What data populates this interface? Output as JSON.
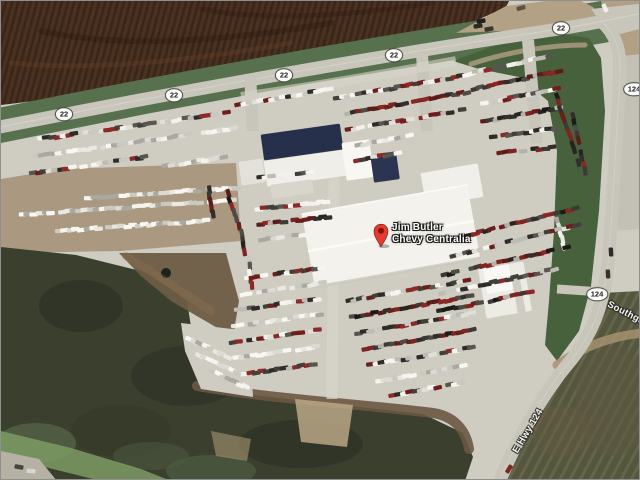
{
  "overlays": {
    "pin": {
      "line1": "Jim Butler",
      "line2": "Chevy Centralia",
      "color": "#e8392c",
      "dot_color": "#7c150e"
    },
    "shields": [
      {
        "text": "22",
        "x": 63,
        "y": 113
      },
      {
        "text": "22",
        "x": 173,
        "y": 94
      },
      {
        "text": "22",
        "x": 283,
        "y": 74
      },
      {
        "text": "22",
        "x": 393,
        "y": 54
      },
      {
        "text": "22",
        "x": 560,
        "y": 27
      },
      {
        "text": "124",
        "x": 633,
        "y": 88
      },
      {
        "text": "124",
        "x": 596,
        "y": 293
      }
    ],
    "road_labels": [
      {
        "text": "E Hwy 124",
        "angle": -59
      },
      {
        "text": "Southgate",
        "angle": 27
      }
    ]
  },
  "satellite": {
    "palettes": {
      "light": [
        "#f4f3ee",
        "#e9e8e2",
        "#dbdad3",
        "#cac9c1",
        "#f8f7f2",
        "#a9a8a1"
      ],
      "mix": [
        "#f2f1eb",
        "#e0dfd8",
        "#bcbbb4",
        "#57564f",
        "#2d2c29",
        "#8b2a26",
        "#c9c8c1",
        "#403f3a",
        "#f6f5f0",
        "#6e1f1d"
      ],
      "dark": [
        "#302f2b",
        "#4c4b46",
        "#1b1a17",
        "#7e2522",
        "#5c1c1a",
        "#b3b2ab",
        "#3b3a36",
        "#8d2623",
        "#262522",
        "#6a1e1b"
      ]
    },
    "layers": [
      {
        "t": "poly",
        "n": "base-pavement",
        "p": "0,0 640,0 640,480 0,480",
        "f": "#cfccc2"
      },
      {
        "t": "poly",
        "n": "plowed-field",
        "p": "0,0 508,0 505,6 470,22 300,62 150,86 0,104",
        "f": "#452e1f"
      },
      {
        "t": "poly",
        "n": "plowed-field-texture",
        "p": "0,0 508,0 505,6 470,22 300,62 150,86 0,104",
        "f": "url(#furrows)"
      },
      {
        "t": "path",
        "n": "field-streak-1",
        "d": "M40,30 C120,48 230,40 330,22",
        "s": "rgba(30,16,8,.25)",
        "w": 6
      },
      {
        "t": "path",
        "n": "field-streak-2",
        "d": "M10,62 C90,70 190,60 290,42",
        "s": "rgba(140,95,55,.16)",
        "w": 5
      },
      {
        "t": "path",
        "n": "field-streak-3",
        "d": "M200,8 C260,20 340,16 430,2",
        "s": "rgba(30,16,8,.2)",
        "w": 5
      },
      {
        "t": "path",
        "n": "grass-hwy22",
        "d": "M-6,129 C150,97 350,60 558,28 C590,23 615,19 646,12",
        "s": "#57704d",
        "w": 42,
        "cap": "butt"
      },
      {
        "t": "poly",
        "n": "lot-main",
        "p": "0,142 150,112 300,84 460,58 520,73 548,98 558,150 554,260 545,330 536,352 480,410 360,402 250,394 196,386 184,330 150,270 78,252 0,246",
        "f": "#cfccc2"
      },
      {
        "t": "poly",
        "n": "grass-median-ne",
        "p": "452,60 500,42 555,32 588,37 600,57 604,110 598,210 590,285 578,330 556,360 544,344 548,300 553,230 556,150 547,100 518,76 478,68",
        "f": "#47613d"
      },
      {
        "t": "path",
        "n": "median-dirt-edge",
        "d": "M470,63 C510,50 550,44 584,44",
        "s": "#b1a084",
        "w": 5,
        "o": 0.8
      },
      {
        "t": "poly",
        "n": "dirt-lot-west",
        "p": "0,178 60,168 235,162 240,240 120,250 0,252",
        "f": "#ab9880"
      },
      {
        "t": "poly",
        "n": "scrubland-sw",
        "p": "0,246 75,254 148,272 186,300 193,345 207,386 252,394 332,403 422,413 462,432 472,456 464,480 0,480",
        "f": "#3b3f2e"
      },
      {
        "t": "ellipse",
        "n": "scrub-dark-blobs",
        "items": [
          [
            80,
            305,
            42,
            26,
            "#2a2e22",
            0.55
          ],
          [
            185,
            375,
            55,
            30,
            "#2a2e22",
            0.5
          ],
          [
            300,
            443,
            62,
            24,
            "#272b20",
            0.5
          ],
          [
            120,
            430,
            50,
            26,
            "#333726",
            0.5
          ]
        ]
      },
      {
        "t": "ellipse",
        "n": "scrub-green-blobs",
        "items": [
          [
            35,
            442,
            40,
            20,
            "#5c6d4e",
            0.6
          ],
          [
            210,
            470,
            45,
            16,
            "#566749",
            0.5
          ],
          [
            150,
            455,
            38,
            14,
            "#4c5c41",
            0.5
          ]
        ]
      },
      {
        "t": "poly",
        "n": "corner-vegetation",
        "p": "0,430 70,447 140,468 170,480 100,480 0,455",
        "f": "#7c9b63",
        "o": 0.85
      },
      {
        "t": "poly",
        "n": "corner-road-patch",
        "p": "0,450 38,458 56,480 0,480",
        "f": "#b5b1a3"
      },
      {
        "t": "poly",
        "n": "dirt-clearing",
        "p": "118,252 225,252 238,300 232,336 170,300 140,275",
        "f": "#6e5c44",
        "o": 0.95
      },
      {
        "t": "circle",
        "n": "pond",
        "items": [
          [
            165,
            272,
            5,
            "#1b231a",
            1
          ]
        ]
      },
      {
        "t": "path",
        "n": "dirt-streak",
        "d": "M125,255 C150,270 180,290 210,310",
        "s": "rgba(140,115,80,.35)",
        "w": 8
      },
      {
        "t": "path",
        "n": "dirt-berm",
        "d": "M196,385 C270,398 360,403 432,412 C452,415 465,428 468,448",
        "s": "#6a5843",
        "w": 10,
        "o": 0.9
      },
      {
        "t": "poly",
        "n": "sand-patch",
        "p": "294,398 352,404 346,446 300,441",
        "f": "#c0ae8a",
        "o": 0.8
      },
      {
        "t": "poly",
        "n": "sand-patch-2",
        "p": "210,430 250,438 246,460 215,455",
        "f": "#a99672",
        "o": 0.6
      },
      {
        "t": "poly",
        "n": "lot-patch-sw",
        "p": "180,322 248,330 252,396 200,388 184,350",
        "f": "#cfccc2"
      },
      {
        "t": "poly",
        "n": "field-se",
        "p": "600,292 640,290 640,480 494,480 560,366 584,332",
        "f": "#54563e"
      },
      {
        "t": "poly",
        "n": "field-se-stripes",
        "p": "600,292 640,290 640,480 494,480 560,366 584,332",
        "f": "url(#mow)"
      },
      {
        "t": "ellipse",
        "n": "field-se-patches",
        "items": [
          [
            612,
            400,
            38,
            55,
            "#5f5741",
            0.5
          ],
          [
            560,
            430,
            30,
            26,
            "#665c43",
            0.45
          ]
        ]
      },
      {
        "t": "path",
        "n": "field-se-dirt-curve",
        "d": "M556,364 C584,344 612,335 642,332",
        "s": "#a6916f",
        "w": 9,
        "o": 0.85
      },
      {
        "t": "poly",
        "n": "shoulder-east",
        "p": "612,58 638,53 640,228 610,230",
        "f": "#c3c0b5"
      },
      {
        "t": "poly",
        "n": "tan-corner-ne",
        "p": "600,0 640,0 640,53 616,56 604,20",
        "f": "#b1a084"
      },
      {
        "t": "poly",
        "n": "tan-intersection",
        "p": "455,32 505,5 545,0 580,0 592,6 600,16 560,26 500,30",
        "f": "#b2a184"
      },
      {
        "t": "path",
        "n": "highway-22",
        "d": "M-6,127 C150,96 350,59 558,28 C590,23 610,19 646,11",
        "s": "#c8c5bb",
        "w": 13
      },
      {
        "t": "poly",
        "n": "junction-fill",
        "p": "590,8 646,2 646,26 616,34 600,22",
        "f": "#c8c5bb"
      },
      {
        "t": "path",
        "n": "highway-124",
        "d": "M600,20 C615,33 620,50 619,74 C616,125 612,200 608,252 C604,306 590,336 566,364 C546,388 516,436 498,482",
        "s": "#c8c5bb",
        "w": 13
      },
      {
        "t": "path",
        "n": "hwy22-centerline",
        "d": "M-6,127 C150,96 350,59 558,28 C590,23 610,19 646,11",
        "s": "#d9d6cb",
        "w": 1.2,
        "o": 0.7
      },
      {
        "t": "path",
        "n": "hwy124-centerline",
        "d": "M600,20 C615,33 620,50 619,74 C616,125 612,200 608,252 C604,306 590,336 566,364 C546,388 516,436 498,482",
        "s": "#d9d6cb",
        "w": 1,
        "o": 0.6
      },
      {
        "t": "path",
        "n": "driveway-1",
        "d": "M249,73 L252,130",
        "s": "#c8c5bb",
        "w": 12,
        "cap": "butt"
      },
      {
        "t": "path",
        "n": "driveway-2",
        "d": "M421,53 L426,130",
        "s": "#c8c5bb",
        "w": 12,
        "cap": "butt"
      },
      {
        "t": "path",
        "n": "driveway-3",
        "d": "M527,39 L536,142",
        "s": "#c8c5bb",
        "w": 12,
        "cap": "butt"
      },
      {
        "t": "path",
        "n": "driveway-124-access",
        "d": "M556,288 L601,291",
        "s": "#c8c5bb",
        "w": 9,
        "cap": "butt"
      },
      {
        "t": "path",
        "n": "lot-cross-drive",
        "d": "M333,168 L331,398",
        "s": "#d7d4ca",
        "w": 11,
        "o": 0.75,
        "cap": "butt"
      },
      {
        "t": "path",
        "n": "lot-top-drive",
        "d": "M240,96 C300,88 380,74 455,60",
        "s": "#d7d4ca",
        "w": 10,
        "o": 0.6,
        "cap": "butt"
      },
      {
        "t": "rect",
        "n": "buildings",
        "items": [
          [
            301,
            141,
            80,
            26,
            -8,
            "#27304a"
          ],
          [
            306,
            167,
            84,
            26,
            -8,
            "#efeee8"
          ],
          [
            357,
            159,
            28,
            38,
            -8,
            "#f8f7f2"
          ],
          [
            384,
            166,
            26,
            28,
            -8,
            "#2b3450"
          ],
          [
            251,
            171,
            24,
            24,
            -8,
            "#e3e1da"
          ],
          [
            291,
            188,
            42,
            14,
            -8,
            "#d8d5cc"
          ],
          [
            451,
            184,
            58,
            34,
            -10,
            "#f0efe9"
          ],
          [
            390,
            235,
            168,
            74,
            -10,
            "#f3f2ec"
          ],
          [
            504,
            289,
            46,
            50,
            -10,
            "#ecebe4"
          ],
          [
            497,
            278,
            26,
            26,
            -10,
            "#f9f8f4"
          ],
          [
            518,
            296,
            8,
            44,
            -10,
            "#cfccc3"
          ]
        ]
      },
      {
        "t": "path",
        "n": "main-bldg-ridge",
        "d": "M308,250 L472,220",
        "s": "#fbfbf8",
        "w": 2.5,
        "o": 0.95
      },
      {
        "t": "path",
        "n": "main-bldg-south-edge",
        "d": "M314,286 L479,257",
        "s": "#c9c7bf",
        "w": 3,
        "o": 0.8
      },
      {
        "t": "path",
        "n": "main-bldg-north-edge",
        "d": "M301,213 L466,184",
        "s": "#ffffff",
        "w": 1.5,
        "o": 0.8
      },
      {
        "t": "rows",
        "n": "parked-cars",
        "rows": [
          [
            238,
            104,
            -10,
            17,
            5.7,
            "mix"
          ],
          [
            40,
            138,
            -8,
            34,
            5.65,
            "mix"
          ],
          [
            36,
            155,
            -8,
            36,
            5.65,
            "light"
          ],
          [
            32,
            172,
            -8,
            21,
            5.65,
            "mix"
          ],
          [
            160,
            166,
            -9,
            12,
            5.7,
            "light"
          ],
          [
            88,
            197,
            -4,
            27,
            5.7,
            "light"
          ],
          [
            16,
            214,
            -4,
            39,
            5.7,
            "light"
          ],
          [
            58,
            230,
            -4,
            27,
            5.7,
            "light"
          ],
          [
            208,
            188,
            82,
            5,
            6.4,
            "dark"
          ],
          [
            336,
            97,
            -10,
            24,
            5.7,
            "mix"
          ],
          [
            342,
            113,
            -10,
            23,
            5.7,
            "dark"
          ],
          [
            348,
            129,
            -10,
            21,
            5.7,
            "mix"
          ],
          [
            352,
            145,
            -10,
            11,
            5.7,
            "light"
          ],
          [
            357,
            159,
            -10,
            8,
            5.7,
            "mix"
          ],
          [
            470,
            72,
            -12,
            15,
            5.7,
            "mix"
          ],
          [
            474,
            88,
            -12,
            16,
            5.7,
            "dark"
          ],
          [
            478,
            104,
            -12,
            15,
            5.7,
            "mix"
          ],
          [
            484,
            120,
            -10,
            14,
            5.7,
            "dark"
          ],
          [
            492,
            136,
            -8,
            12,
            5.7,
            "mix"
          ],
          [
            500,
            152,
            -6,
            10,
            5.7,
            "dark"
          ],
          [
            556,
            96,
            72,
            12,
            6.2,
            "dark"
          ],
          [
            572,
            116,
            78,
            10,
            6.2,
            "dark"
          ],
          [
            556,
            220,
            75,
            5,
            6.5,
            "light"
          ],
          [
            248,
            178,
            -7,
            13,
            5.6,
            "mix"
          ],
          [
            258,
            208,
            -6,
            13,
            5.6,
            "mix"
          ],
          [
            260,
            223,
            -6,
            13,
            5.6,
            "dark"
          ],
          [
            262,
            238,
            -6,
            8,
            5.6,
            "light"
          ],
          [
            227,
            193,
            72,
            5,
            6.3,
            "dark"
          ],
          [
            239,
            226,
            80,
            6,
            6.3,
            "dark"
          ],
          [
            248,
            259,
            85,
            5,
            6.3,
            "mix"
          ],
          [
            247,
            277,
            -8,
            14,
            5.7,
            "mix"
          ],
          [
            242,
            293,
            -8,
            15,
            5.7,
            "light"
          ],
          [
            238,
            309,
            -8,
            15,
            5.7,
            "mix"
          ],
          [
            234,
            325,
            -8,
            16,
            5.7,
            "light"
          ],
          [
            232,
            341,
            -8,
            16,
            5.7,
            "mix"
          ],
          [
            236,
            357,
            -8,
            15,
            5.7,
            "light"
          ],
          [
            244,
            373,
            -8,
            13,
            5.7,
            "mix"
          ],
          [
            348,
            300,
            -10,
            22,
            5.7,
            "mix"
          ],
          [
            352,
            316,
            -10,
            22,
            5.7,
            "dark"
          ],
          [
            358,
            332,
            -10,
            21,
            5.7,
            "mix"
          ],
          [
            364,
            348,
            -10,
            20,
            5.7,
            "dark"
          ],
          [
            370,
            364,
            -10,
            19,
            5.7,
            "mix"
          ],
          [
            378,
            380,
            -10,
            16,
            5.7,
            "light"
          ],
          [
            392,
            394,
            -10,
            13,
            5.7,
            "mix"
          ],
          [
            452,
            238,
            -14,
            23,
            5.7,
            "dark"
          ],
          [
            448,
            256,
            -14,
            24,
            5.7,
            "mix"
          ],
          [
            444,
            274,
            -13,
            23,
            5.7,
            "dark"
          ],
          [
            442,
            292,
            -12,
            21,
            5.7,
            "mix"
          ],
          [
            440,
            310,
            -12,
            17,
            5.7,
            "dark"
          ],
          [
            188,
            338,
            25,
            8,
            6,
            "light"
          ],
          [
            198,
            354,
            25,
            8,
            6,
            "light"
          ],
          [
            212,
            371,
            25,
            7,
            6,
            "light"
          ]
        ]
      },
      {
        "t": "cars",
        "n": "road-vehicles",
        "items": [
          [
            480,
            20,
            -10,
            "#1f1e1b"
          ],
          [
            477,
            25,
            -10,
            "#2c2a26"
          ],
          [
            488,
            28,
            -10,
            "#3a362f"
          ],
          [
            520,
            7,
            -15,
            "#5e5245"
          ],
          [
            604,
            7,
            65,
            "#efeee8"
          ],
          [
            610,
            251,
            87,
            "#2e2c29"
          ],
          [
            607,
            273,
            87,
            "#35332f"
          ],
          [
            508,
            468,
            -58,
            "#7e2723"
          ],
          [
            18,
            466,
            10,
            "#46443f"
          ],
          [
            30,
            470,
            5,
            "#d8d6cf"
          ]
        ]
      }
    ]
  }
}
